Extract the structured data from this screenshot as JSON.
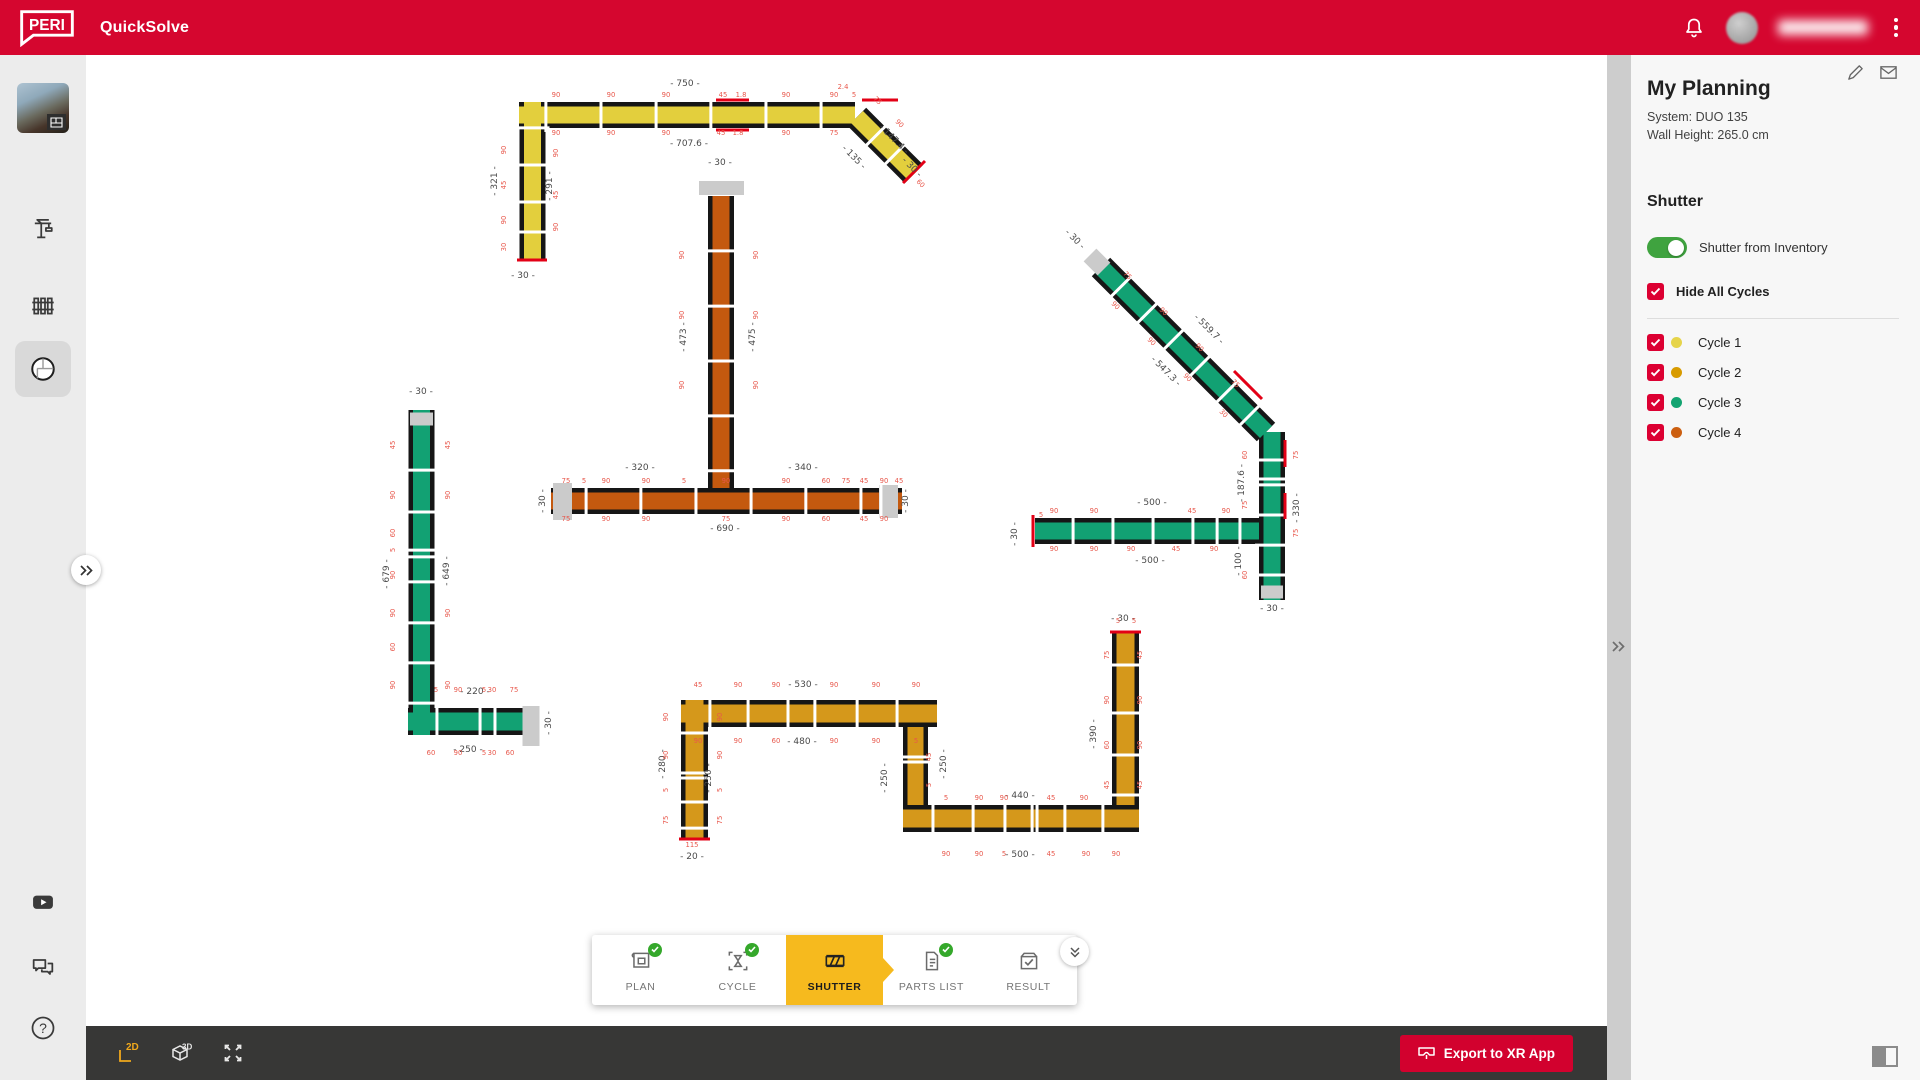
{
  "header": {
    "logo": "PERI",
    "app": "QuickSolve",
    "icons": [
      "bell-icon",
      "avatar",
      "overflow-menu-icon"
    ],
    "user_name_obscured": true
  },
  "sidebar": {
    "items": [
      "project-thumbnail",
      "crane-icon",
      "formwork-panels-icon",
      "floorplan-icon"
    ],
    "active_item": "floorplan-icon",
    "bottom_items": [
      "youtube-icon",
      "chat-icon",
      "help-icon",
      "info-icon"
    ]
  },
  "panel": {
    "title": "My Planning",
    "system": "System: DUO 135",
    "wall_height": "Wall Height: 265.0 cm",
    "icons": [
      "edit-pencil-icon",
      "mail-icon"
    ],
    "section": "Shutter",
    "toggle_label": "Shutter from Inventory",
    "toggle_on": true,
    "hide_all": "Hide All Cycles",
    "hide_all_checked": true,
    "cycles": [
      {
        "label": "Cycle 1",
        "color": "#E6D44A",
        "checked": true
      },
      {
        "label": "Cycle 2",
        "color": "#D89B00",
        "checked": true
      },
      {
        "label": "Cycle 3",
        "color": "#13A471",
        "checked": true
      },
      {
        "label": "Cycle 4",
        "color": "#CC5F10",
        "checked": true
      }
    ]
  },
  "tabs": [
    {
      "label": "PLAN",
      "complete": true
    },
    {
      "label": "CYCLE",
      "complete": true
    },
    {
      "label": "SHUTTER",
      "active": true
    },
    {
      "label": "PARTS LIST",
      "complete": true
    },
    {
      "label": "RESULT"
    }
  ],
  "toolbar": {
    "view_2d": "2D",
    "view_3d": "3D",
    "active_view": "2D",
    "icons": [
      "view-2d-icon",
      "view-3d-icon",
      "fullscreen-icon"
    ],
    "export_label": "Export to XR App"
  },
  "plan": {
    "colors": {
      "outline": "#161616",
      "Y": "#E3CF3D",
      "O": "#C4590F",
      "G": "#12A173",
      "A": "#D5981B"
    },
    "cycle_of_color": {
      "Y": "Cycle 1",
      "A": "Cycle 2",
      "G": "Cycle 3",
      "O": "Cycle 4"
    },
    "segments": [
      {
        "x1": 433,
        "y1": 60,
        "x2": 769,
        "y2": 60,
        "w": 26,
        "c": "Y",
        "j": [
          0.08,
          0.244,
          0.408,
          0.571,
          0.735,
          0.899
        ]
      },
      {
        "x1": 446.5,
        "y1": 47,
        "x2": 446.5,
        "y2": 206,
        "w": 26,
        "c": "Y",
        "j": [
          0.163,
          0.396,
          0.629,
          0.818
        ]
      },
      {
        "x1": 771,
        "y1": 62,
        "x2": 828,
        "y2": 119,
        "w": 26,
        "c": "Y",
        "j": [
          0.33,
          0.66
        ]
      },
      {
        "x1": 635,
        "y1": 141,
        "x2": 635,
        "y2": 433,
        "w": 26,
        "c": "O",
        "j": [
          0.188,
          0.377,
          0.565,
          0.753,
          0.941
        ]
      },
      {
        "x1": 465,
        "y1": 446,
        "x2": 816,
        "y2": 446,
        "w": 26,
        "c": "O",
        "j": [
          0.1,
          0.256,
          0.413,
          0.57,
          0.726,
          0.883,
          0.94
        ]
      },
      {
        "x1": 335.5,
        "y1": 355,
        "x2": 335.5,
        "y2": 680,
        "w": 26,
        "c": "G",
        "j": [
          0.185,
          0.314,
          0.431,
          0.452,
          0.529,
          0.655,
          0.778,
          0.902
        ]
      },
      {
        "x1": 322,
        "y1": 666.5,
        "x2": 453,
        "y2": 666.5,
        "w": 27,
        "c": "G",
        "j": [
          0.221,
          0.55,
          0.664
        ]
      },
      {
        "x1": 1015,
        "y1": 212,
        "x2": 1180,
        "y2": 377,
        "w": 26,
        "c": "G",
        "j": [
          0.12,
          0.28,
          0.44,
          0.6,
          0.76,
          0.9
        ]
      },
      {
        "x1": 1186,
        "y1": 377,
        "x2": 1186,
        "y2": 545,
        "w": 26,
        "c": "G",
        "j": [
          0.167,
          0.28,
          0.315,
          0.494,
          0.673,
          0.851
        ]
      },
      {
        "x1": 949,
        "y1": 476,
        "x2": 1173,
        "y2": 476,
        "w": 26,
        "c": "G",
        "j": [
          0.17,
          0.348,
          0.527,
          0.705,
          0.813,
          0.915
        ]
      },
      {
        "x1": 608.5,
        "y1": 645,
        "x2": 608.5,
        "y2": 783,
        "w": 27,
        "c": "A",
        "j": [
          0.239,
          0.529,
          0.565,
          0.739,
          0.928
        ]
      },
      {
        "x1": 595,
        "y1": 658.5,
        "x2": 851,
        "y2": 658.5,
        "w": 27,
        "c": "A",
        "j": [
          0.113,
          0.262,
          0.418,
          0.523,
          0.688,
          0.844
        ]
      },
      {
        "x1": 829.5,
        "y1": 672,
        "x2": 829.5,
        "y2": 750,
        "w": 25,
        "c": "A",
        "j": [
          0.385,
          0.449
        ]
      },
      {
        "x1": 817,
        "y1": 763.5,
        "x2": 1053,
        "y2": 763.5,
        "w": 27,
        "c": "A",
        "j": [
          0.127,
          0.297,
          0.432,
          0.547,
          0.568,
          0.686,
          0.847
        ]
      },
      {
        "x1": 1039.5,
        "y1": 578,
        "x2": 1039.5,
        "y2": 750,
        "w": 27,
        "c": "A",
        "j": [
          0.186,
          0.465,
          0.709,
          0.942
        ]
      }
    ],
    "caps": [
      [
        613,
        133,
        658,
        133,
        14
      ],
      [
        476.5,
        428,
        476.5,
        465,
        19
      ],
      [
        802.5,
        430,
        802.5,
        463,
        19
      ],
      [
        324,
        364,
        347,
        364,
        13
      ],
      [
        445,
        651,
        445,
        691,
        17
      ],
      [
        1004,
        200,
        1018,
        214,
        18
      ],
      [
        1175,
        537,
        1197,
        537,
        13
      ]
    ],
    "redlines": [
      [
        431,
        205,
        461,
        205
      ],
      [
        817,
        128,
        839,
        106
      ],
      [
        947,
        460,
        947,
        492
      ],
      [
        593,
        784,
        624,
        784
      ],
      [
        1024,
        577,
        1055,
        577
      ],
      [
        630,
        45,
        663,
        45
      ],
      [
        630,
        75,
        663,
        75
      ],
      [
        776,
        45,
        812,
        45
      ],
      [
        1148,
        316,
        1176,
        344
      ],
      [
        1199,
        385,
        1199,
        412
      ],
      [
        1199,
        438,
        1199,
        464
      ]
    ],
    "dims_major": [
      [
        "- 750 -",
        599,
        31,
        0
      ],
      [
        "- 707.6 -",
        603,
        91,
        0
      ],
      [
        "- 321 -",
        411,
        126,
        -90
      ],
      [
        "- 291 -",
        466,
        131,
        -90
      ],
      [
        "- 30 -",
        437,
        223,
        0
      ],
      [
        "- 147.4 -",
        806,
        86,
        45
      ],
      [
        "- 135 -",
        766,
        104,
        45
      ],
      [
        "- 30 -",
        824,
        114,
        45
      ],
      [
        "- 30 -",
        634,
        110,
        0
      ],
      [
        "- 473 -",
        600,
        282,
        -90
      ],
      [
        "- 475 -",
        669,
        282,
        -90
      ],
      [
        "- 320 -",
        554,
        415,
        0
      ],
      [
        "- 340 -",
        717,
        415,
        0
      ],
      [
        "- 690 -",
        639,
        476,
        0
      ],
      [
        "- 30 -",
        459,
        446,
        -90
      ],
      [
        "- 30 -",
        822,
        446,
        -90
      ],
      [
        "- 30 -",
        335,
        339,
        0
      ],
      [
        "- 679 -",
        303,
        519,
        -90
      ],
      [
        "- 649 -",
        363,
        516,
        -90
      ],
      [
        "- 220 -",
        389,
        639,
        0
      ],
      [
        "- 250 -",
        382,
        697,
        0
      ],
      [
        "- 30 -",
        465,
        668,
        -90
      ],
      [
        "- 30 -",
        987,
        186,
        45
      ],
      [
        "- 559.7 -",
        1121,
        276,
        45
      ],
      [
        "- 547.3 -",
        1078,
        318,
        45
      ],
      [
        "- 187.6 -",
        1158,
        428,
        -90
      ],
      [
        "- 330 -",
        1213,
        453,
        -90
      ],
      [
        "- 100 -",
        1155,
        506,
        -90
      ],
      [
        "- 30 -",
        1186,
        556,
        0
      ],
      [
        "- 500 -",
        1066,
        450,
        0
      ],
      [
        "- 500 -",
        1064,
        508,
        0
      ],
      [
        "- 30 -",
        931,
        479,
        -90
      ],
      [
        "- 530 -",
        717,
        632,
        0
      ],
      [
        "- 480 -",
        716,
        689,
        0
      ],
      [
        "- 280 -",
        579,
        709,
        -90
      ],
      [
        "- 250 -",
        625,
        723,
        -90
      ],
      [
        "- 250 -",
        801,
        723,
        -90
      ],
      [
        "- 250 -",
        860,
        709,
        -90
      ],
      [
        "- 440 -",
        934,
        743,
        0
      ],
      [
        "- 500 -",
        934,
        802,
        0
      ],
      [
        "- 390 -",
        1010,
        679,
        -90
      ],
      [
        "- 30 -",
        1037,
        566,
        0
      ],
      [
        "- 20 -",
        606,
        804,
        0
      ]
    ],
    "dims_minor": [
      [
        "90",
        470,
        42,
        0
      ],
      [
        "90",
        525,
        42,
        0
      ],
      [
        "90",
        580,
        42,
        0
      ],
      [
        "45",
        637,
        42,
        0
      ],
      [
        "1.8",
        655,
        42,
        0
      ],
      [
        "90",
        700,
        42,
        0
      ],
      [
        "90",
        748,
        42,
        0
      ],
      [
        "5",
        768,
        42,
        0
      ],
      [
        "2.4",
        757,
        34,
        0
      ],
      [
        "90",
        470,
        80,
        0
      ],
      [
        "90",
        525,
        80,
        0
      ],
      [
        "90",
        580,
        80,
        0
      ],
      [
        "45",
        635,
        80,
        0
      ],
      [
        "1.8",
        652,
        80,
        0
      ],
      [
        "90",
        700,
        80,
        0
      ],
      [
        "75",
        748,
        80,
        0
      ],
      [
        "90",
        420,
        95,
        -90
      ],
      [
        "45",
        420,
        130,
        -90
      ],
      [
        "90",
        420,
        165,
        -90
      ],
      [
        "30",
        420,
        192,
        -90
      ],
      [
        "90",
        472,
        98,
        -90
      ],
      [
        "45",
        472,
        140,
        -90
      ],
      [
        "90",
        472,
        172,
        -90
      ],
      [
        "75",
        790,
        47,
        45
      ],
      [
        "90",
        812,
        70,
        45
      ],
      [
        "60",
        833,
        130,
        45
      ],
      [
        "90",
        598,
        200,
        -90
      ],
      [
        "90",
        598,
        260,
        -90
      ],
      [
        "90",
        598,
        330,
        -90
      ],
      [
        "90",
        672,
        200,
        -90
      ],
      [
        "90",
        672,
        260,
        -90
      ],
      [
        "90",
        672,
        330,
        -90
      ],
      [
        "75",
        480,
        428,
        0
      ],
      [
        "5",
        498,
        428,
        0
      ],
      [
        "90",
        520,
        428,
        0
      ],
      [
        "90",
        560,
        428,
        0
      ],
      [
        "5",
        598,
        428,
        0
      ],
      [
        "90",
        640,
        428,
        0
      ],
      [
        "90",
        700,
        428,
        0
      ],
      [
        "60",
        740,
        428,
        0
      ],
      [
        "75",
        760,
        428,
        0
      ],
      [
        "45",
        778,
        428,
        0
      ],
      [
        "90",
        798,
        428,
        0
      ],
      [
        "45",
        813,
        428,
        0
      ],
      [
        "75",
        480,
        466,
        0
      ],
      [
        "90",
        520,
        466,
        0
      ],
      [
        "90",
        560,
        466,
        0
      ],
      [
        "75",
        640,
        466,
        0
      ],
      [
        "90",
        700,
        466,
        0
      ],
      [
        "60",
        740,
        466,
        0
      ],
      [
        "45",
        778,
        466,
        0
      ],
      [
        "90",
        798,
        466,
        0
      ],
      [
        "45",
        309,
        390,
        -90
      ],
      [
        "90",
        309,
        440,
        -90
      ],
      [
        "60",
        309,
        478,
        -90
      ],
      [
        "5",
        309,
        495,
        -90
      ],
      [
        "90",
        309,
        520,
        -90
      ],
      [
        "90",
        309,
        558,
        -90
      ],
      [
        "60",
        309,
        592,
        -90
      ],
      [
        "90",
        309,
        630,
        -90
      ],
      [
        "45",
        364,
        390,
        -90
      ],
      [
        "90",
        364,
        440,
        -90
      ],
      [
        "90",
        364,
        558,
        -90
      ],
      [
        "90",
        364,
        630,
        -90
      ],
      [
        "5",
        350,
        637,
        0
      ],
      [
        "90",
        372,
        637,
        0
      ],
      [
        "5",
        398,
        637,
        0
      ],
      [
        "30",
        406,
        637,
        0
      ],
      [
        "75",
        428,
        637,
        0
      ],
      [
        "60",
        345,
        700,
        0
      ],
      [
        "90",
        372,
        700,
        0
      ],
      [
        "5",
        398,
        700,
        0
      ],
      [
        "30",
        406,
        700,
        0
      ],
      [
        "60",
        424,
        700,
        0
      ],
      [
        "75",
        1040,
        222,
        45
      ],
      [
        "90",
        1076,
        258,
        45
      ],
      [
        "90",
        1112,
        294,
        45
      ],
      [
        "75",
        1148,
        330,
        45
      ],
      [
        "90",
        1028,
        252,
        45
      ],
      [
        "90",
        1064,
        288,
        45
      ],
      [
        "90",
        1100,
        324,
        45
      ],
      [
        "30",
        1136,
        360,
        45
      ],
      [
        "60",
        1161,
        400,
        -90
      ],
      [
        "75",
        1161,
        450,
        -90
      ],
      [
        "60",
        1161,
        520,
        -90
      ],
      [
        "75",
        1212,
        400,
        -90
      ],
      [
        "75",
        1212,
        478,
        -90
      ],
      [
        "90",
        968,
        458,
        0
      ],
      [
        "90",
        1008,
        458,
        0
      ],
      [
        "45",
        1106,
        458,
        0
      ],
      [
        "90",
        1140,
        458,
        0
      ],
      [
        "90",
        968,
        496,
        0
      ],
      [
        "90",
        1008,
        496,
        0
      ],
      [
        "90",
        1045,
        496,
        0
      ],
      [
        "45",
        1090,
        496,
        0
      ],
      [
        "90",
        1128,
        496,
        0
      ],
      [
        "5",
        955,
        462,
        0
      ],
      [
        "90",
        582,
        662,
        -90
      ],
      [
        "90",
        582,
        700,
        -90
      ],
      [
        "5",
        582,
        735,
        -90
      ],
      [
        "75",
        582,
        765,
        -90
      ],
      [
        "90",
        636,
        662,
        -90
      ],
      [
        "90",
        636,
        700,
        -90
      ],
      [
        "5",
        636,
        735,
        -90
      ],
      [
        "75",
        636,
        765,
        -90
      ],
      [
        "115",
        606,
        792,
        0
      ],
      [
        "45",
        612,
        632,
        0
      ],
      [
        "90",
        652,
        632,
        0
      ],
      [
        "90",
        690,
        632,
        0
      ],
      [
        "90",
        748,
        632,
        0
      ],
      [
        "90",
        790,
        632,
        0
      ],
      [
        "90",
        830,
        632,
        0
      ],
      [
        "90",
        612,
        688,
        0
      ],
      [
        "90",
        652,
        688,
        0
      ],
      [
        "60",
        690,
        688,
        0
      ],
      [
        "90",
        748,
        688,
        0
      ],
      [
        "90",
        790,
        688,
        0
      ],
      [
        "5",
        830,
        688,
        0
      ],
      [
        "45",
        845,
        702,
        -90
      ],
      [
        "5",
        845,
        730,
        -90
      ],
      [
        "5",
        1032,
        568,
        0
      ],
      [
        "5",
        1048,
        568,
        0
      ],
      [
        "5",
        860,
        745,
        0
      ],
      [
        "90",
        893,
        745,
        0
      ],
      [
        "90",
        918,
        745,
        0
      ],
      [
        "45",
        965,
        745,
        0
      ],
      [
        "90",
        998,
        745,
        0
      ],
      [
        "90",
        860,
        801,
        0
      ],
      [
        "90",
        893,
        801,
        0
      ],
      [
        "5",
        918,
        801,
        0
      ],
      [
        "45",
        965,
        801,
        0
      ],
      [
        "90",
        1000,
        801,
        0
      ],
      [
        "90",
        1030,
        801,
        0
      ],
      [
        "75",
        1023,
        600,
        -90
      ],
      [
        "90",
        1023,
        645,
        -90
      ],
      [
        "60",
        1023,
        690,
        -90
      ],
      [
        "45",
        1023,
        730,
        -90
      ],
      [
        "45",
        1056,
        600,
        -90
      ],
      [
        "90",
        1056,
        645,
        -90
      ],
      [
        "90",
        1056,
        690,
        -90
      ],
      [
        "45",
        1056,
        730,
        -90
      ]
    ]
  }
}
